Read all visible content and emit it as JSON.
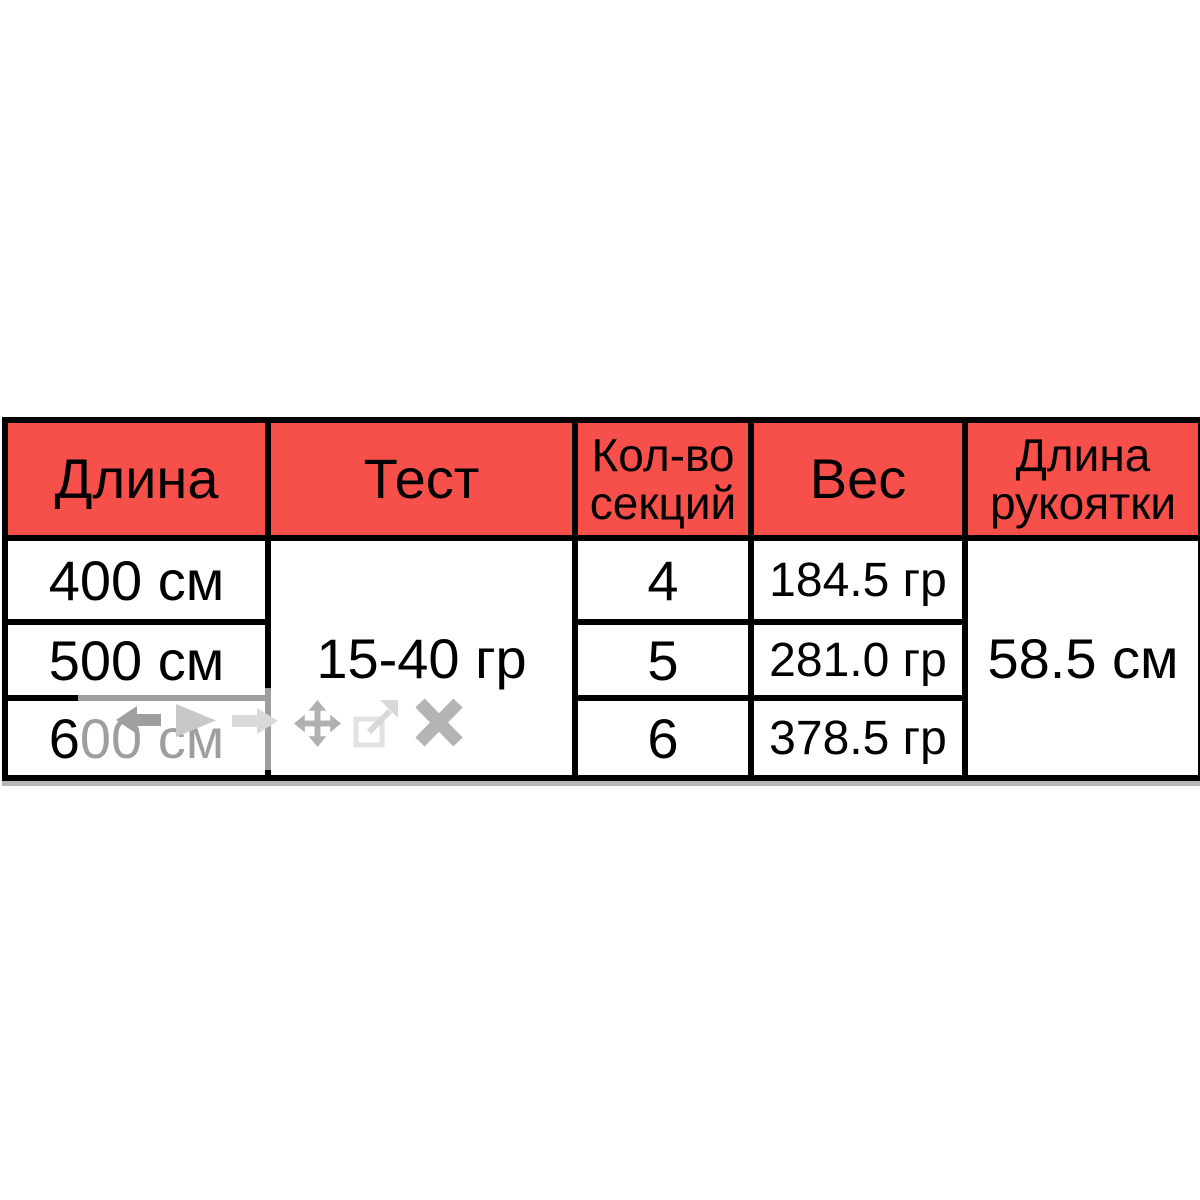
{
  "table": {
    "columns": [
      "Длина",
      "Тест",
      "Кол-во секций",
      "Вес",
      "Длина рукоятки"
    ],
    "rows": [
      {
        "length": "400 см",
        "sections": "4",
        "weight": "184.5 гр"
      },
      {
        "length": "500 см",
        "sections": "5",
        "weight": "281.0 гр"
      },
      {
        "length": "600 см",
        "sections": "6",
        "weight": "378.5 гр"
      }
    ],
    "test_value": "15-40 гр",
    "handle_length_value": "58.5 см",
    "colors": {
      "header_bg": "#f7504b",
      "border": "#000000",
      "body_bg": "#ffffff"
    }
  },
  "overlay": {
    "description": "semi-transparent object-selection widget",
    "icons": [
      {
        "name": "move-left-icon"
      },
      {
        "name": "play-icon"
      },
      {
        "name": "move-right-icon"
      },
      {
        "name": "drag-move-icon"
      },
      {
        "name": "resize-icon"
      },
      {
        "name": "delete-icon"
      }
    ]
  }
}
